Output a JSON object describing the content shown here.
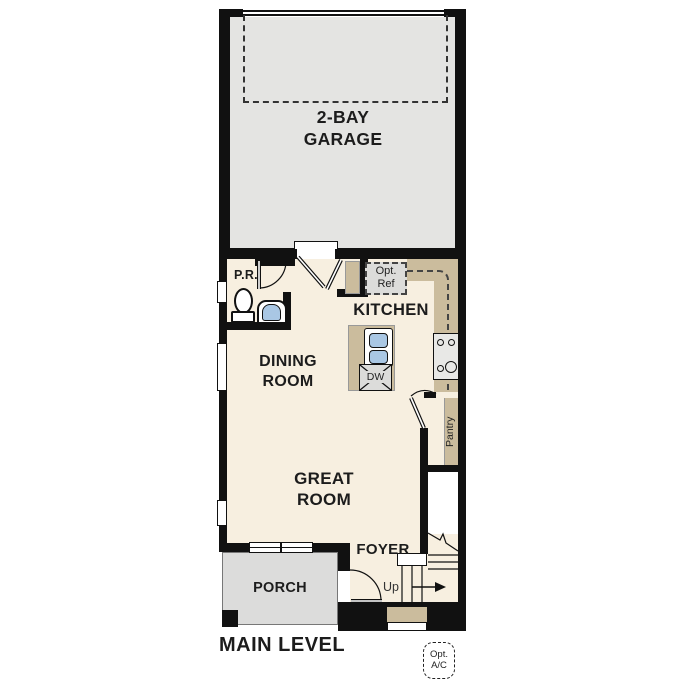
{
  "title": "MAIN LEVEL",
  "rooms": {
    "garage": {
      "label": "2-BAY\nGARAGE"
    },
    "kitchen": {
      "label": "KITCHEN"
    },
    "dining_room": {
      "label": "DINING\nROOM"
    },
    "great_room": {
      "label": "GREAT\nROOM"
    },
    "foyer": {
      "label": "FOYER"
    },
    "porch": {
      "label": "PORCH"
    },
    "powder_room": {
      "label": "P.R."
    },
    "pantry": {
      "label": "Pantry"
    }
  },
  "annotations": {
    "optional_refrigerator": "Opt.\nRef",
    "dishwasher": "DW",
    "stairs_direction": "Up",
    "optional_ac": "Opt.\nA/C"
  },
  "colors": {
    "wall": "#111111",
    "garage-floor": "#e4e4e2",
    "main-floor": "#f7efe0",
    "counter": "#cbbc9d",
    "porch-floor": "#dcdcdb",
    "fixture-blue": "#a9c7e4",
    "appliance-gray": "#dcdcda"
  }
}
